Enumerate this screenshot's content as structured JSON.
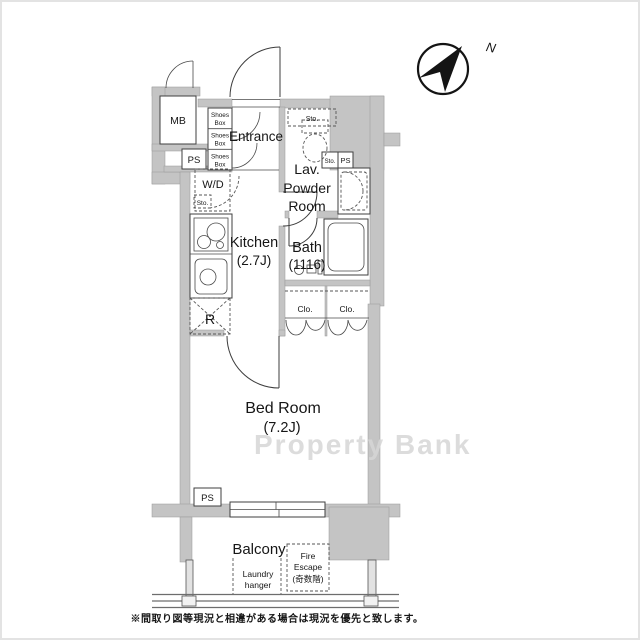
{
  "colors": {
    "wall_color": "#c4c4c4",
    "line_color": "#3c3c3c",
    "watermark_color": "#d6d6d6",
    "compass_color": "#141414"
  },
  "compass": {
    "north_label": "N"
  },
  "rooms": {
    "entrance": "Entrance",
    "lav_line1": "Lav.",
    "lav_line2": "Powder",
    "lav_line3": "Room",
    "kitchen_line1": "Kitchen",
    "kitchen_line2": "(2.7J)",
    "bath_line1": "Bath",
    "bath_line2": "(1116)",
    "bedroom_line1": "Bed Room",
    "bedroom_line2": "(7.2J)",
    "balcony": "Balcony"
  },
  "fixtures": {
    "meter_box": "MB",
    "pipe_space": "PS",
    "washer_dryer": "W/D",
    "storage": "Sto.",
    "shoes_line1": "Shoes",
    "shoes_line2": "Box",
    "refrigerator": "R",
    "closet": "Clo.",
    "fire_escape_line1": "Fire",
    "fire_escape_line2": "Escape",
    "fire_escape_line3": "(奇数階)",
    "laundry_line1": "Laundry",
    "laundry_line2": "hanger"
  },
  "watermark": {
    "text": "Property Bank"
  },
  "disclaimer": {
    "text": "※間取り図等現況と相違がある場合は現況を優先と致します。"
  }
}
